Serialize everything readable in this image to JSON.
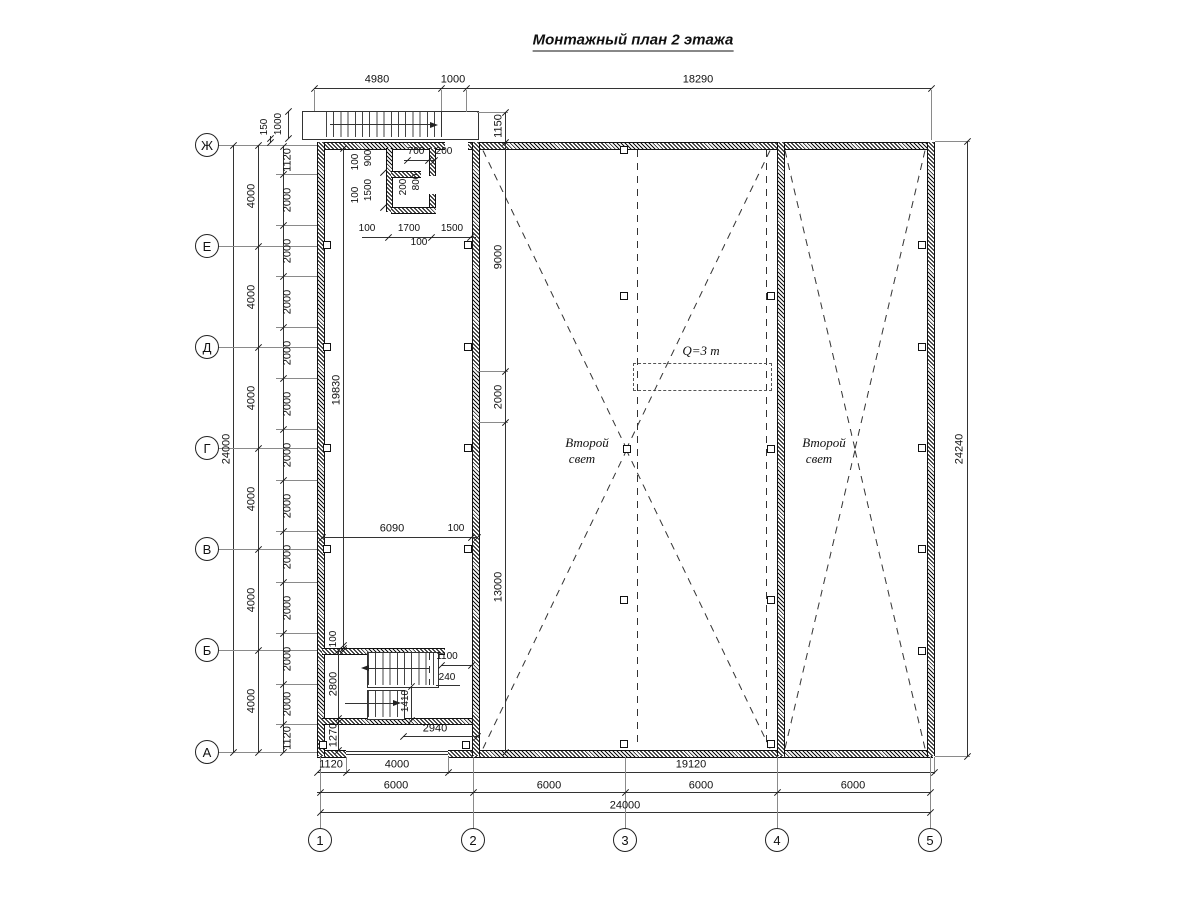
{
  "title": "Монтажный план 2 этажа",
  "axes": {
    "rows": [
      "Ж",
      "Е",
      "Д",
      "Г",
      "В",
      "Б",
      "А"
    ],
    "cols": [
      "1",
      "2",
      "3",
      "4",
      "5"
    ]
  },
  "annotations": {
    "crane_capacity": "Q=3 т",
    "second_light_line1": "Второй",
    "second_light_line2": "свет"
  },
  "dims": {
    "top_chain": [
      "4980",
      "1000",
      "18290"
    ],
    "top_stair": {
      "h_offset": "150",
      "width": "1000"
    },
    "left": {
      "total": "24000",
      "axes": [
        "4000",
        "4000",
        "4000",
        "4000",
        "4000",
        "4000"
      ],
      "inner": [
        "1120",
        "2000",
        "2000",
        "2000",
        "2000",
        "2000",
        "2000",
        "2000",
        "2000",
        "2000",
        "2000",
        "2000",
        "1120"
      ]
    },
    "right": {
      "total": "24240"
    },
    "axis2_chain": [
      "1150",
      "9000",
      "2000",
      "13000"
    ],
    "mid": {
      "width": "6090",
      "wall": "100",
      "height": "19830"
    },
    "room": {
      "v1": "100",
      "v2": "900",
      "v3": "100",
      "v4": "1500",
      "t1": "700",
      "t2": "200",
      "i1": "200",
      "i2": "800",
      "b1": "100",
      "b2": "1700",
      "b3": "1500",
      "b4": "100"
    },
    "stair": {
      "gap": "100",
      "height": "2800",
      "below": "1270",
      "door": "1100",
      "wall": "240",
      "flight": "1410",
      "width": "2940"
    },
    "bottom": {
      "chain1": [
        "1120",
        "4000",
        "19120"
      ],
      "chain2": [
        "6000",
        "6000",
        "6000",
        "6000"
      ],
      "total": "24000"
    }
  },
  "colors": {
    "line": "#1a1a1a",
    "bg": "#ffffff"
  }
}
